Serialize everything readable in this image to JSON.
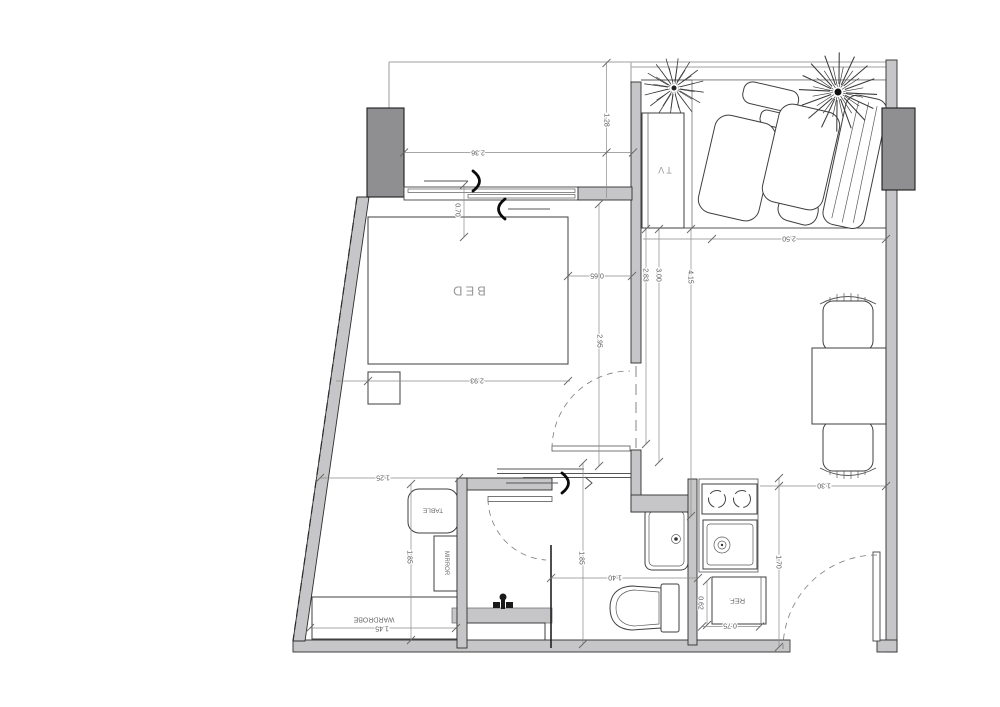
{
  "plan": {
    "type": "apartment-floor-plan",
    "labels": {
      "bed": "BED",
      "tv": "TV",
      "table": "TABLE",
      "mirror": "MIRROR",
      "wardrobe": "WARDROBE",
      "fridge": "REF."
    },
    "dimensions": {
      "balcony": {
        "width": "2.36",
        "offset": "1.28",
        "panel": "0.70"
      },
      "bedroom": {
        "bed_clearance": "0.65",
        "depth": "2.95",
        "bed_width": "2.93",
        "inner": "2.83",
        "mid": "3.00",
        "overall": "4.15"
      },
      "living": {
        "width": "2.50",
        "entry": "1.30",
        "kitchen_side": "1.70"
      },
      "bathroom": {
        "width": "1.40",
        "depth": "1.85"
      },
      "dressing": {
        "width": "1.25",
        "depth": "1.85",
        "wardrobe": "1.45"
      },
      "kitchen": {
        "fridge_depth": "0.62",
        "fridge_width": "0.75"
      }
    },
    "colors": {
      "wall_light": "#c6c6c8",
      "wall_dark": "#8f8f91",
      "outline": "#2e2e2e",
      "dim_line": "#8a8a8a",
      "dim_text": "#575757",
      "label_text": "#9a9a9a",
      "background": "#ffffff"
    }
  }
}
